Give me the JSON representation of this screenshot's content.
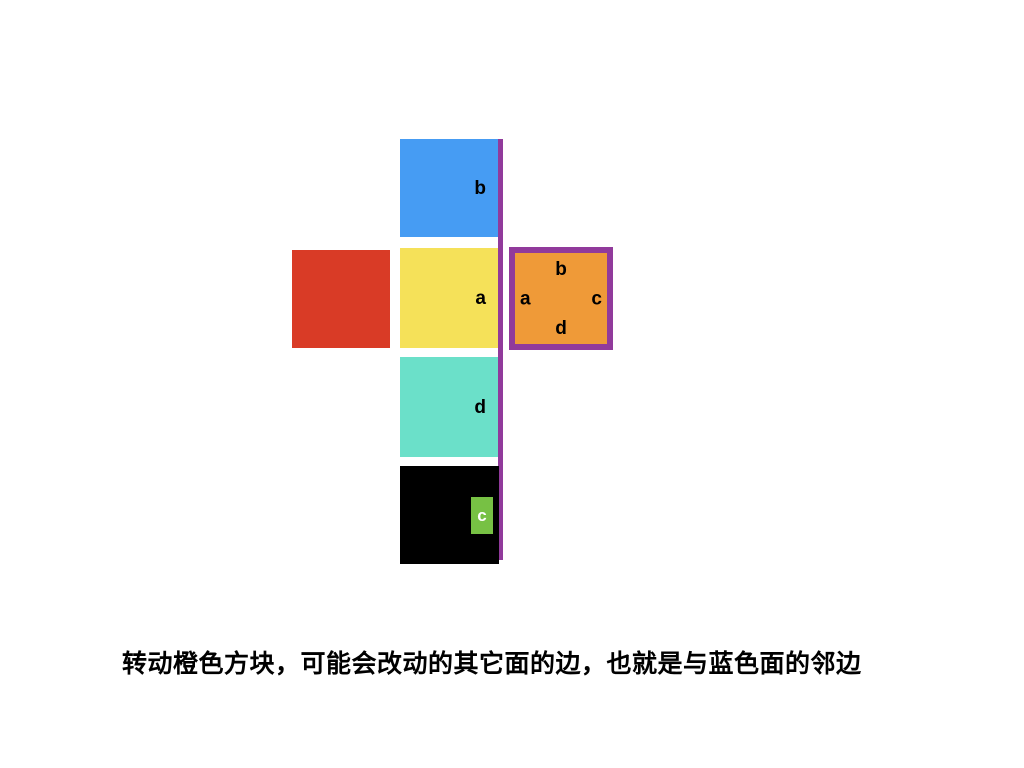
{
  "faces": {
    "blue": {
      "label": "b",
      "color": "#469CF3"
    },
    "red": {
      "color": "#D93B26"
    },
    "yellow": {
      "label": "a",
      "color": "#F5E159"
    },
    "teal": {
      "label": "d",
      "color": "#6BE0C9"
    },
    "black": {
      "label": "c",
      "color": "#000000",
      "badge_color": "#77C144"
    },
    "orange": {
      "label_top": "b",
      "label_left": "a",
      "label_right": "c",
      "label_bottom": "d",
      "color": "#EF9A38",
      "border_color": "#913A9B"
    }
  },
  "highlight_line": {
    "color": "#913A9B"
  },
  "caption": "转动橙色方块，可能会改动的其它面的边，也就是与蓝色面的邻边"
}
